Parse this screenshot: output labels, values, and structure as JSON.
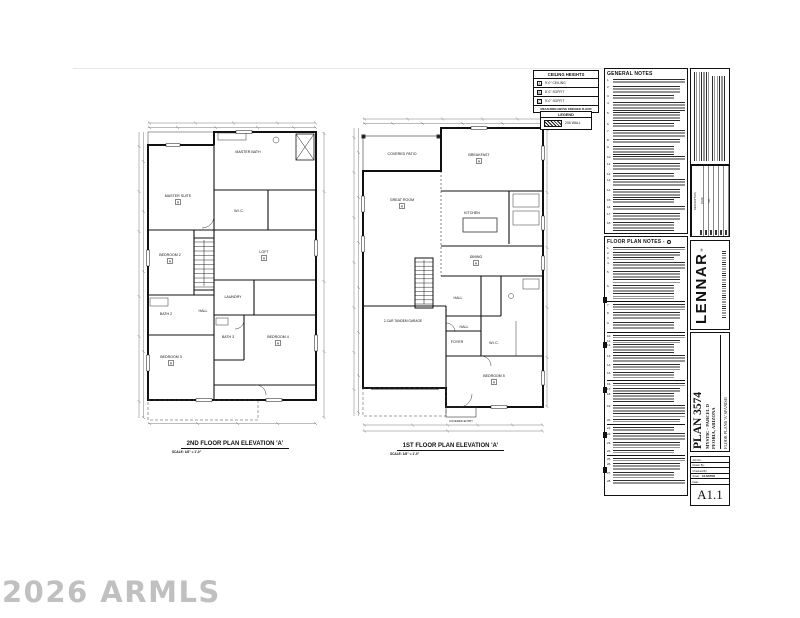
{
  "watermark": "2026 ARMLS",
  "ceiling_heights": {
    "title": "CEILING HEIGHTS",
    "rows": [
      {
        "key": "A",
        "value": "9'-0\" CEILING"
      },
      {
        "key": "B",
        "value": "8'-0\" SOFFIT"
      },
      {
        "key": "C",
        "value": "9'-0\" SOFFIT"
      }
    ],
    "footnote": "MEASURED ABOVE FINISHED FLOOR"
  },
  "legend": {
    "title": "LEGEND",
    "item": "2X6 WALL"
  },
  "general_notes": {
    "title": "GENERAL NOTES"
  },
  "floor_plan_notes": {
    "title": "FLOOR PLAN NOTES -"
  },
  "plans": [
    {
      "title": "2ND FLOOR PLAN ELEVATION 'A'",
      "scale": "SCALE: 1/8\" = 1'-0\"",
      "rooms": [
        {
          "label": "MASTER SUITE",
          "key": "A"
        },
        {
          "label": "MASTER BATH",
          "key": ""
        },
        {
          "label": "W.I.C.",
          "key": ""
        },
        {
          "label": "BEDROOM 2",
          "key": "A"
        },
        {
          "label": "LOFT",
          "key": "A"
        },
        {
          "label": "LAUNDRY",
          "key": ""
        },
        {
          "label": "HALL",
          "key": ""
        },
        {
          "label": "BATH 2",
          "key": ""
        },
        {
          "label": "BATH 3",
          "key": ""
        },
        {
          "label": "BEDROOM 3",
          "key": "A"
        },
        {
          "label": "BEDROOM 4",
          "key": "A"
        }
      ]
    },
    {
      "title": "1ST FLOOR PLAN ELEVATION 'A'",
      "scale": "SCALE: 1/8\" = 1'-0\"",
      "rooms": [
        {
          "label": "COVERED PATIO",
          "key": ""
        },
        {
          "label": "BREAKFAST",
          "key": "A"
        },
        {
          "label": "GREAT ROOM",
          "key": "A"
        },
        {
          "label": "KITCHEN",
          "key": ""
        },
        {
          "label": "DINING",
          "key": "A"
        },
        {
          "label": "HALL",
          "key": ""
        },
        {
          "label": "HALL",
          "key": ""
        },
        {
          "label": "FOYER",
          "key": ""
        },
        {
          "label": "W.I.C.",
          "key": ""
        },
        {
          "label": "2-CAR TANDEM GARAGE",
          "key": ""
        },
        {
          "label": "BEDROOM 5",
          "key": "A"
        },
        {
          "label": "COVERED ENTRY",
          "key": ""
        }
      ]
    }
  ],
  "title_block": {
    "brand": "LENNAR",
    "brand_reg": "®",
    "plan_title": "PLAN 3574",
    "community": "MYSTIC - PARCEL D",
    "location": "PEORIA, ARIZONA",
    "sheet_desc": "FLOOR PLANS 'A' SPANISH",
    "revision_headers": [
      "NO.",
      "DATE",
      "DESCRIPTION"
    ],
    "fields": [
      {
        "label": "Job No:",
        "value": ""
      },
      {
        "label": "Drawn By:",
        "value": ""
      },
      {
        "label": "Checked By:",
        "value": ""
      },
      {
        "label": "Scale:",
        "value": "AS NOTED"
      },
      {
        "label": "Date:",
        "value": ""
      }
    ],
    "sheet_number": "A1.1"
  }
}
